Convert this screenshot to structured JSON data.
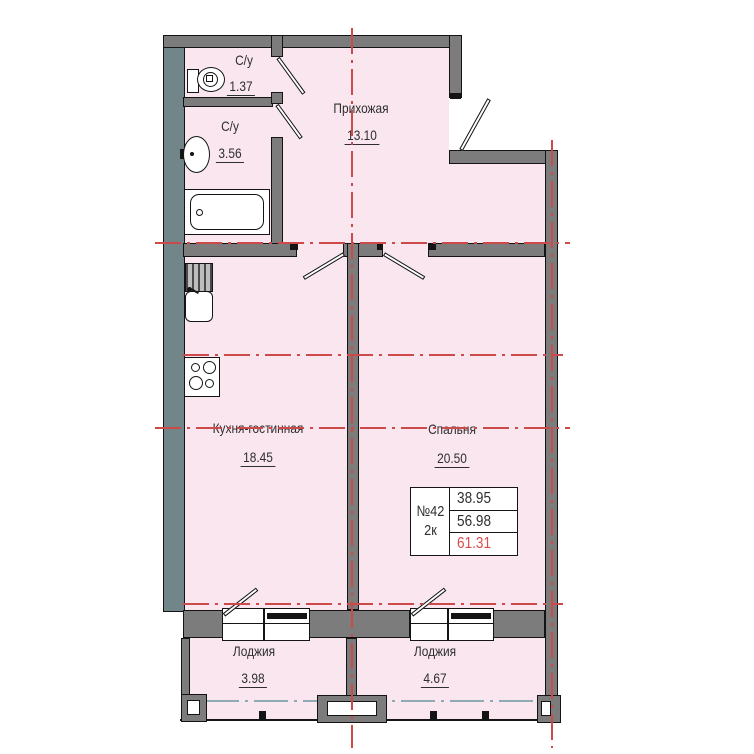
{
  "plan": {
    "rooms": [
      {
        "id": "hallway",
        "name": "Прихожая",
        "area": "13.10"
      },
      {
        "id": "wc-small",
        "name": "С/у",
        "area": "1.37"
      },
      {
        "id": "wc-large",
        "name": "С/у",
        "area": "3.56"
      },
      {
        "id": "kitchen-living",
        "name": "Кухня-гостинная",
        "area": "18.45"
      },
      {
        "id": "bedroom",
        "name": "Спальня",
        "area": "20.50"
      },
      {
        "id": "loggia-left",
        "name": "Лоджия",
        "area": "3.98"
      },
      {
        "id": "loggia-right",
        "name": "Лоджия",
        "area": "4.67"
      }
    ],
    "info_table": {
      "apartment_number": "№42",
      "rooms_count": "2к",
      "living_area": "38.95",
      "floor_area": "56.98",
      "total_area": "61.31"
    },
    "colors": {
      "room_fill": "#f9e6ef",
      "interior_wall": "#7c7c7c",
      "exterior_wall": "#72868a",
      "axis_red": "#cd4a4a",
      "glazing_blue": "#8fa9b5",
      "total_area_red": "#d94b4b"
    }
  }
}
